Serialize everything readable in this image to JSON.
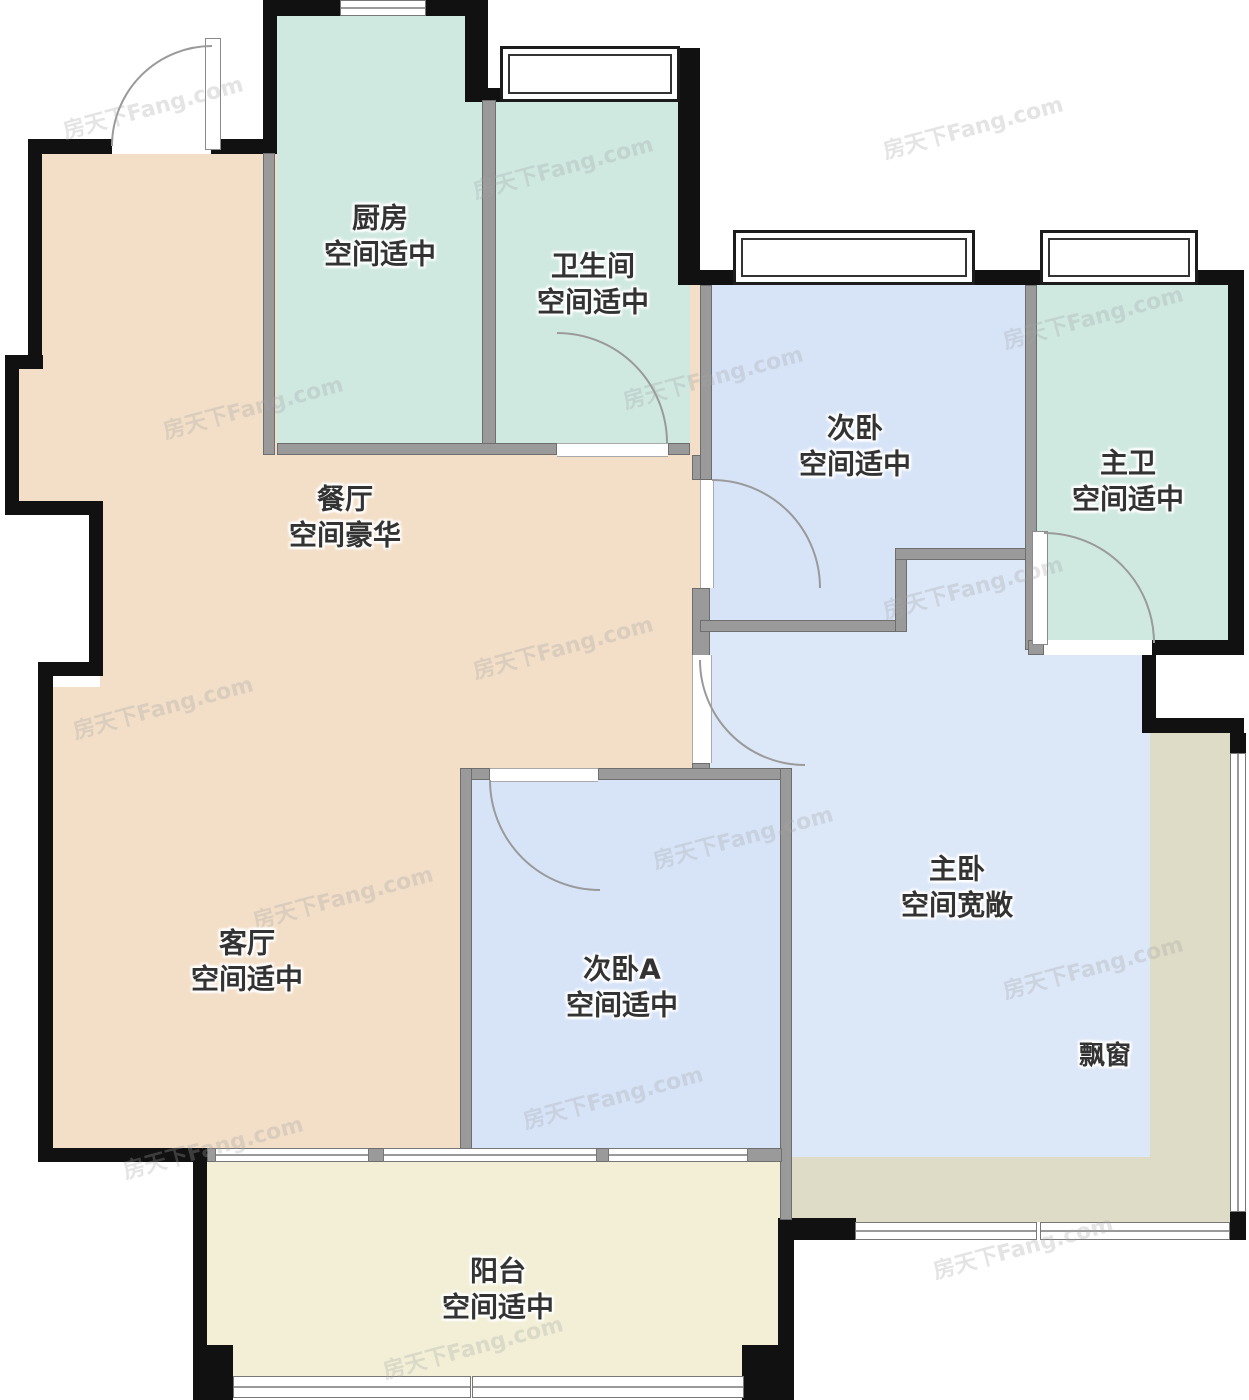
{
  "floorplan": {
    "watermark": "房天下Fang.com",
    "bay_window_label": "飘窗",
    "colors": {
      "wall": "#111111",
      "interior_wall": "#9a9a9a",
      "kitchen_bath_fill": "#cfe9e1",
      "dining_living_fill": "#f3dfc8",
      "bedroom_fill": "#d7e4f8",
      "master_fill": "#dce7f8",
      "bay_window_fill": "#dedcc6",
      "balcony_fill": "#f2efd6"
    },
    "rooms": [
      {
        "id": "kitchen",
        "name": "厨房",
        "desc": "空间适中"
      },
      {
        "id": "bathroom",
        "name": "卫生间",
        "desc": "空间适中"
      },
      {
        "id": "bedroom-2",
        "name": "次卧",
        "desc": "空间适中"
      },
      {
        "id": "master-bath",
        "name": "主卫",
        "desc": "空间适中"
      },
      {
        "id": "dining-room",
        "name": "餐厅",
        "desc": "空间豪华"
      },
      {
        "id": "living-room",
        "name": "客厅",
        "desc": "空间适中"
      },
      {
        "id": "bedroom-2a",
        "name": "次卧A",
        "desc": "空间适中"
      },
      {
        "id": "master-bedroom",
        "name": "主卧",
        "desc": "空间宽敞"
      },
      {
        "id": "balcony",
        "name": "阳台",
        "desc": "空间适中"
      }
    ]
  }
}
